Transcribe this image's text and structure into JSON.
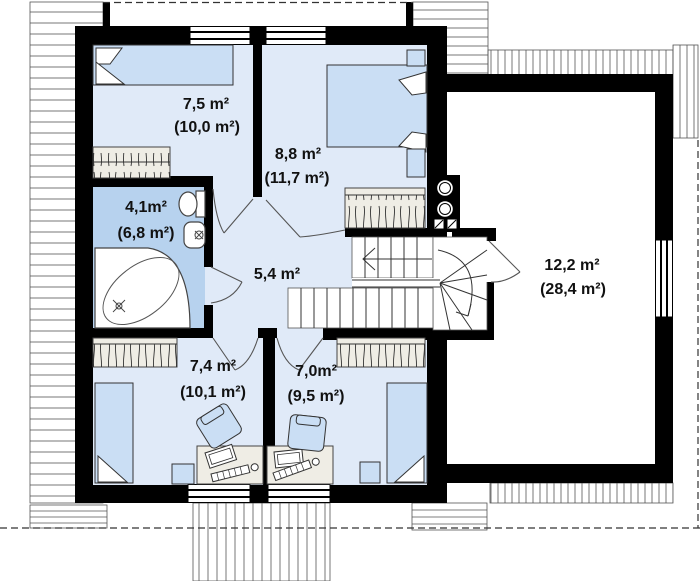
{
  "plan": {
    "type": "floor-plan",
    "storey": "attic / first floor",
    "rooms": [
      {
        "name": "bedroom-top-left",
        "area": "7,5 m²",
        "gross_area": "(10,0 m²)"
      },
      {
        "name": "bedroom-top-right",
        "area": "8,8 m²",
        "gross_area": "(11,7 m²)"
      },
      {
        "name": "bathroom",
        "area": "4,1m²",
        "gross_area": "(6,8 m²)"
      },
      {
        "name": "hallway",
        "area": "5,4 m²",
        "gross_area": ""
      },
      {
        "name": "bedroom-bottom-left",
        "area": "7,4 m²",
        "gross_area": "(10,1 m²)"
      },
      {
        "name": "bedroom-bottom-right",
        "area": "7,0m²",
        "gross_area": "(9,5 m²)"
      },
      {
        "name": "attic-room",
        "area": "12,2 m²",
        "gross_area": "(28,4 m²)"
      }
    ]
  },
  "colors": {
    "wall": "#000000",
    "room_floor": "#e0eaf8",
    "bathroom_floor": "#b7d2ee",
    "furniture_blue": "#cadef4",
    "furniture_outline": "#333333",
    "cabinet_fill": "#efede5",
    "hatch_line": "#777777",
    "label_text": "#111111"
  }
}
